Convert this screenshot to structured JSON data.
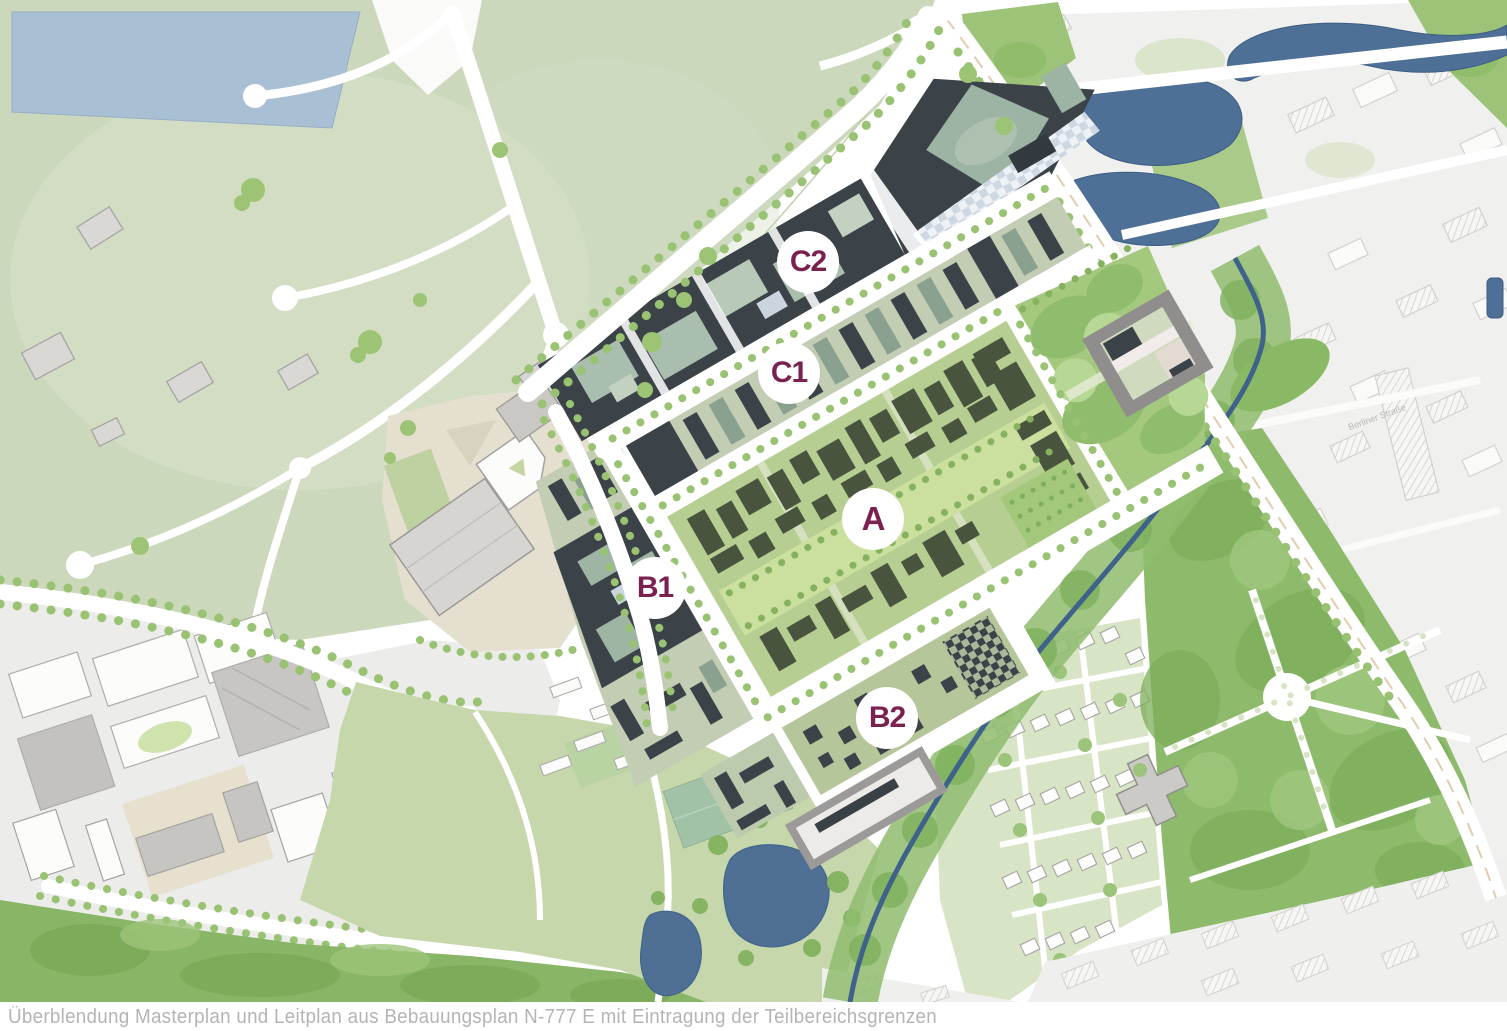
{
  "map": {
    "type": "urban-design-masterplan",
    "caption": "Überblendung Masterplan und Leitplan aus Bebauungsplan N-777 E mit Eintragung der Teilbereichsgrenzen",
    "plan_reference": "N-777 E",
    "zone_labels": [
      {
        "id": "C2",
        "label": "C2",
        "cx": 808,
        "cy": 262
      },
      {
        "id": "C1",
        "label": "C1",
        "cx": 789,
        "cy": 373
      },
      {
        "id": "A",
        "label": "A",
        "cx": 873,
        "cy": 519
      },
      {
        "id": "B1",
        "label": "B1",
        "cx": 655,
        "cy": 588
      },
      {
        "id": "B2",
        "label": "B2",
        "cx": 887,
        "cy": 718
      }
    ],
    "street_labels": [
      {
        "label": "Berliner Straße"
      }
    ],
    "colors": {
      "zone_label_text": "#7b2150",
      "zone_label_bg": "#ffffff",
      "caption_text": "#b4b4b4",
      "development_blocks": "#3b4349",
      "courtyard_green": "#a9beae",
      "zone_a_green": "#b6ce91",
      "parkland_pale": "#ccd8bc",
      "greenery_mid": "#8fbb6d",
      "water": "#4e6f96",
      "urban_gray": "#f0f0ee",
      "plaza_beige": "#e5dfd0",
      "road_white": "#ffffff"
    }
  }
}
